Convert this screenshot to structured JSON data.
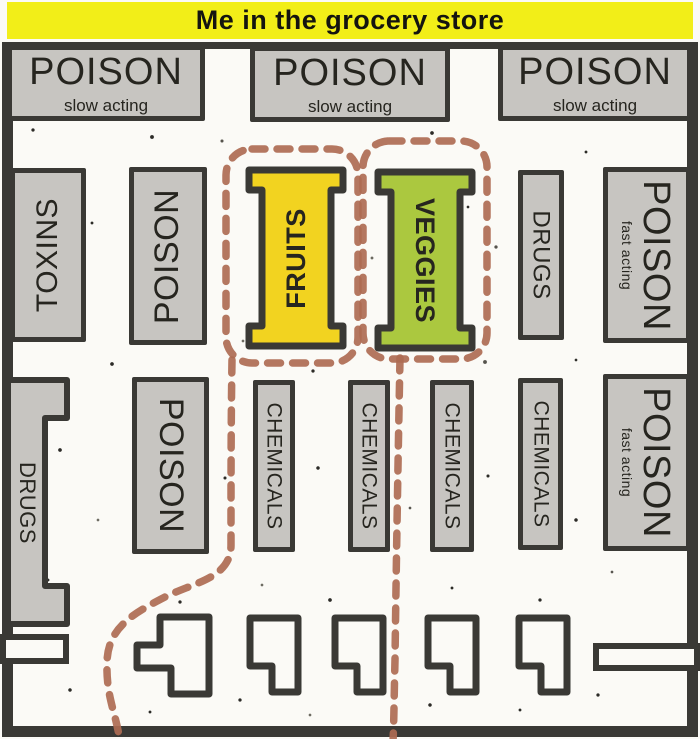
{
  "banner": {
    "title": "Me in the grocery store"
  },
  "colors": {
    "banner_yellow": "#f2ee18",
    "wall": "#3a3935",
    "aisle_gray": "#c7c5c1",
    "fruits_yellow": "#f2d320",
    "veggies_green": "#abc83f",
    "path_brown": "#ae6b52",
    "floor": "#fbfaf6",
    "counter_white": "#fbfaf6",
    "ink": "#26251f"
  },
  "top_row": [
    {
      "label": "POISON",
      "sub": "slow acting"
    },
    {
      "label": "POISON",
      "sub": "slow acting"
    },
    {
      "label": "POISON",
      "sub": "slow acting"
    }
  ],
  "middle_row": {
    "toxins": "TOXINS",
    "poison": "POISON",
    "fruits": "FRUITS",
    "veggies": "VEGGIES",
    "drugs": "DRUGS",
    "poison_fast": {
      "label": "POISON",
      "sub": "fast acting"
    }
  },
  "bottom_row": {
    "drugs": "DRUGS",
    "poison": "POISON",
    "chemicals": [
      "CHEMICALS",
      "CHEMICALS",
      "CHEMICALS",
      "CHEMICALS"
    ],
    "poison_fast": {
      "label": "POISON",
      "sub": "fast acting"
    }
  }
}
